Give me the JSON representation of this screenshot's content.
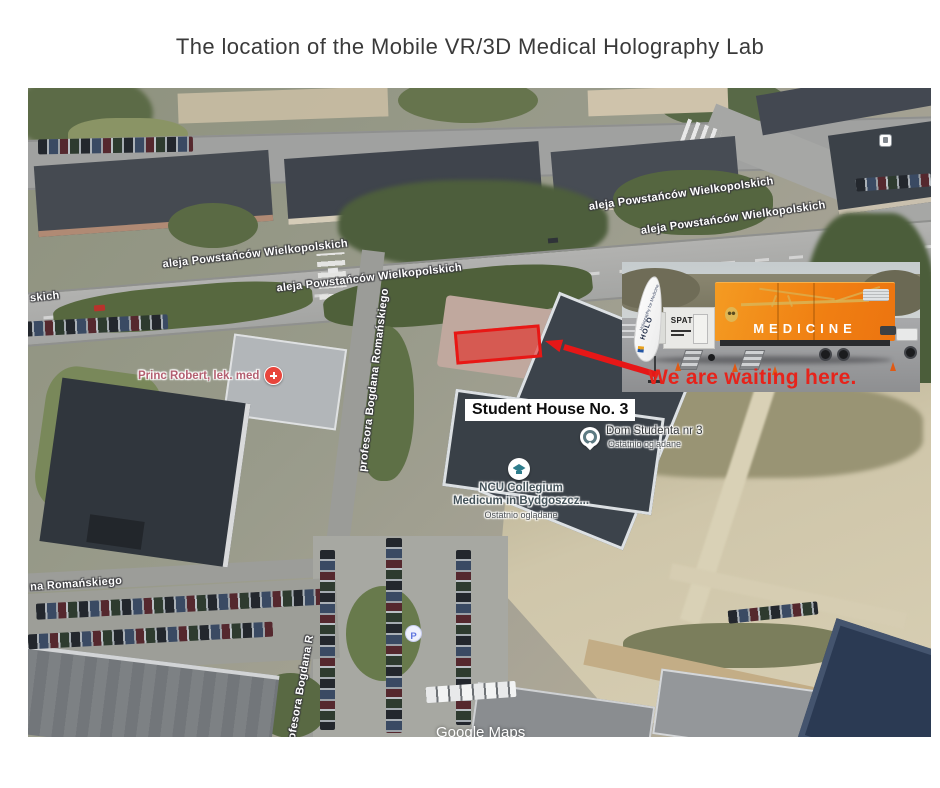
{
  "title": "The location of the Mobile VR/3D Medical Holography Lab",
  "map": {
    "watermark": "Google Maps",
    "streets": {
      "aleja": "aleja Powstańców Wielkopolskich",
      "aleja_partial": "skich",
      "romanskiego": "profesora Bogdana Romańskiego",
      "romanskiego_partial": "na Romańskiego",
      "romanskiego_lower": "profesora Bogdana R"
    },
    "pois": {
      "princ_robert": {
        "label": "Princ Robert, lek. med"
      },
      "dom_studenta": {
        "label": "Dom Studenta nr 3",
        "sublabel": "Ostatnio oglądane"
      },
      "ncu": {
        "line1": "NCU Collegium",
        "line2": "Medicum in Bydgoszcz...",
        "sublabel": "Ostatnio oglądane"
      },
      "parking": {
        "label": "P"
      }
    },
    "annotations": {
      "student_house": "Student House No. 3",
      "waiting": "We are waiting here."
    }
  },
  "photo": {
    "flag_title": "HOLO",
    "flag_tagline": "Holography for Medicine",
    "trailer_front": "SPATIAL",
    "trailer_side": "MEDICINE"
  },
  "icons": {
    "medical": "medical-cross-icon",
    "education": "graduation-cap-icon",
    "recent": "recently-viewed-icon",
    "parking": "parking-icon",
    "bus": "bus-stop-icon"
  },
  "colors": {
    "accent_red": "#e61717",
    "trailer_orange": "#f07f12",
    "poi_health": "#b35f70",
    "poi_text": "#3e4347"
  }
}
